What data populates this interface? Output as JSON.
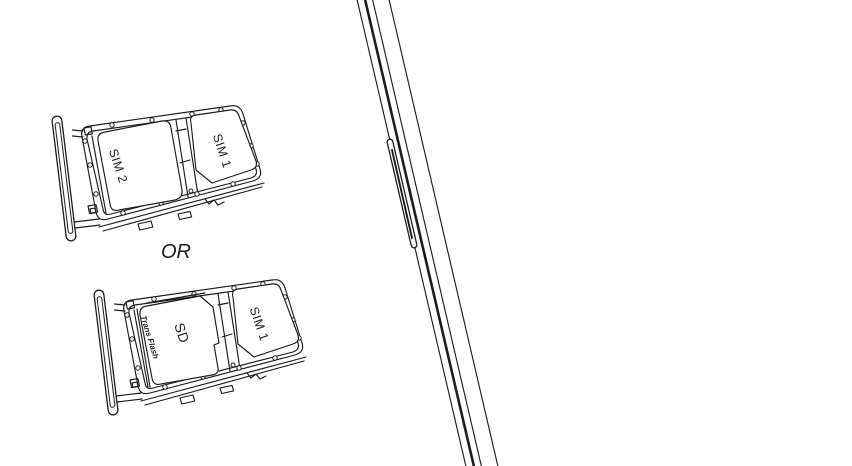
{
  "figure": {
    "background": "#ffffff",
    "line_color": "#1d1d1b",
    "or_separator": "OR",
    "tray_option_dual_sim": {
      "left_slot_label": "SIM 2",
      "right_slot_label": "SIM 1"
    },
    "tray_option_sim_sd": {
      "left_slot_brand": "Trans Flash",
      "left_slot_label": "SD",
      "right_slot_label": "SIM 1"
    }
  }
}
